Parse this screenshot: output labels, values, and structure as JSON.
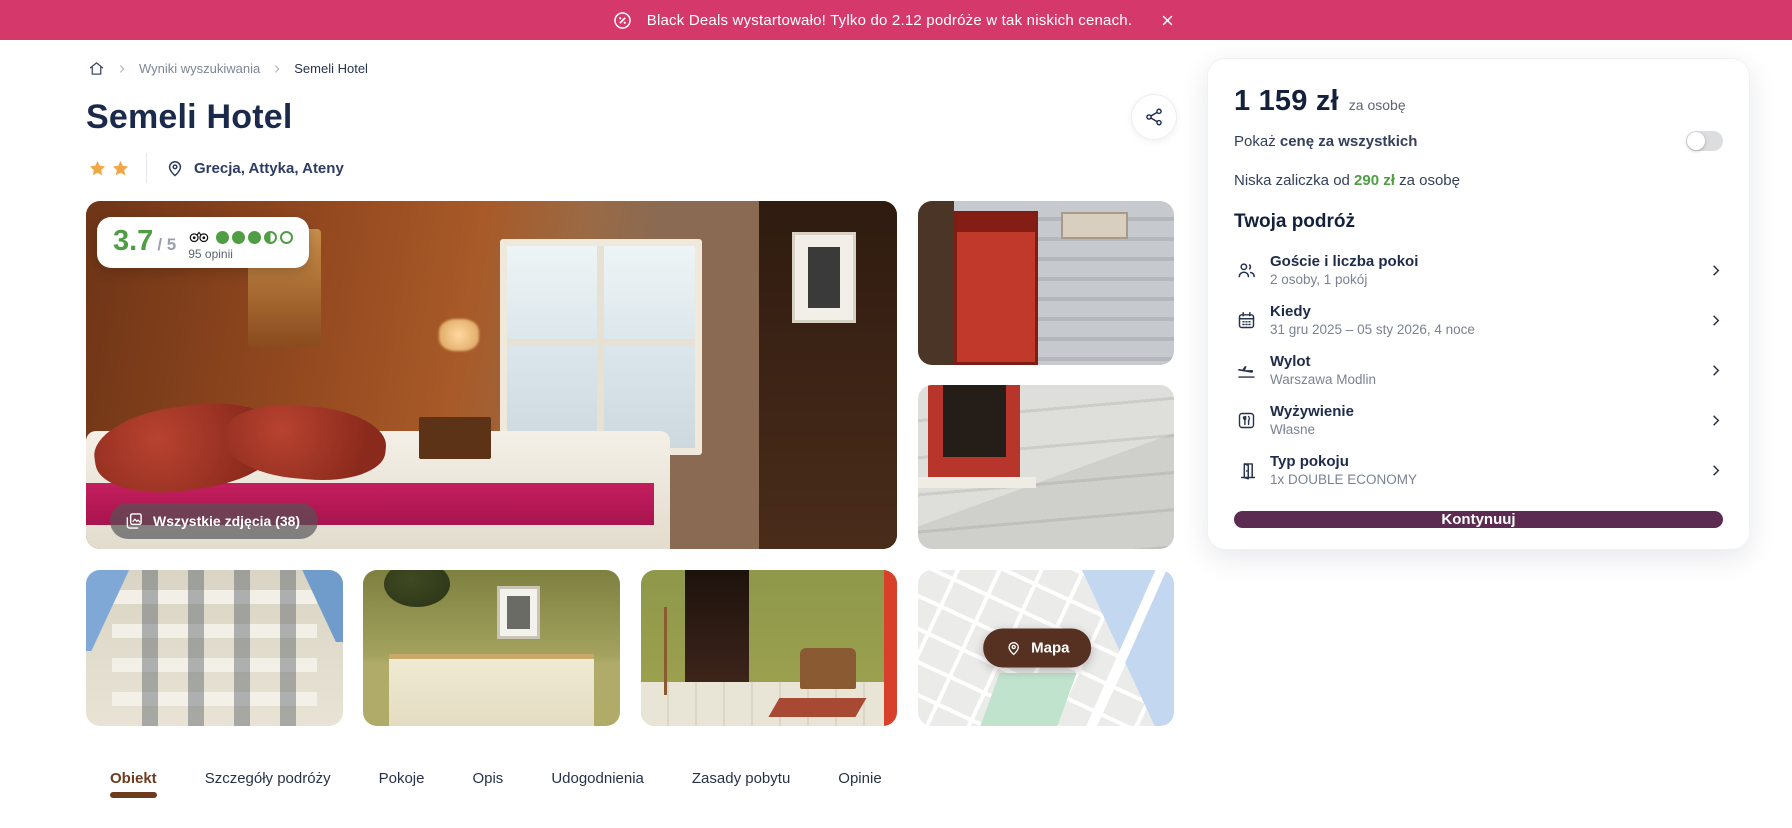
{
  "banner": {
    "text": "Black Deals wystartowało! Tylko do 2.12 podróże w tak niskich cenach.",
    "accent_color": "#d5396b"
  },
  "breadcrumb": {
    "items": [
      "Wyniki wyszukiwania",
      "Semeli Hotel"
    ]
  },
  "header": {
    "title": "Semeli Hotel",
    "star_count": 2,
    "location": "Grecja, Attyka, Ateny"
  },
  "gallery": {
    "rating": {
      "score": "3.7",
      "scale": "/ 5",
      "reviews": "95 opinii",
      "dots_full": 3,
      "dots_half": 1,
      "dots_empty": 1,
      "score_color": "#4f9e44"
    },
    "all_photos_label": "Wszystkie zdjęcia (38)",
    "map_button_label": "Mapa"
  },
  "booking": {
    "price": "1 159 zł",
    "price_suffix": "za osobę",
    "show_price_prefix": "Pokaż ",
    "show_price_bold": "cenę za wszystkich",
    "toggle_on": false,
    "deposit_prefix": "Niska zaliczka od ",
    "deposit_amount": "290 zł",
    "deposit_suffix": " za osobę",
    "trip_title": "Twoja podróż",
    "trip_items": [
      {
        "icon": "guests-icon",
        "title": "Goście i liczba pokoi",
        "value": "2 osoby, 1 pokój"
      },
      {
        "icon": "calendar-icon",
        "title": "Kiedy",
        "value": "31 gru 2025 – 05 sty 2026, 4 noce"
      },
      {
        "icon": "plane-icon",
        "title": "Wylot",
        "value": "Warszawa Modlin"
      },
      {
        "icon": "meals-icon",
        "title": "Wyżywienie",
        "value": "Własne"
      },
      {
        "icon": "door-icon",
        "title": "Typ pokoju",
        "value": "1x DOUBLE ECONOMY"
      }
    ],
    "continue_label": "Kontynuuj",
    "button_color": "#5c2b52"
  },
  "tabs": [
    {
      "label": "Obiekt",
      "active": true
    },
    {
      "label": "Szczegóły podróży",
      "active": false
    },
    {
      "label": "Pokoje",
      "active": false
    },
    {
      "label": "Opis",
      "active": false
    },
    {
      "label": "Udogodnienia",
      "active": false
    },
    {
      "label": "Zasady pobytu",
      "active": false
    },
    {
      "label": "Opinie",
      "active": false
    }
  ]
}
